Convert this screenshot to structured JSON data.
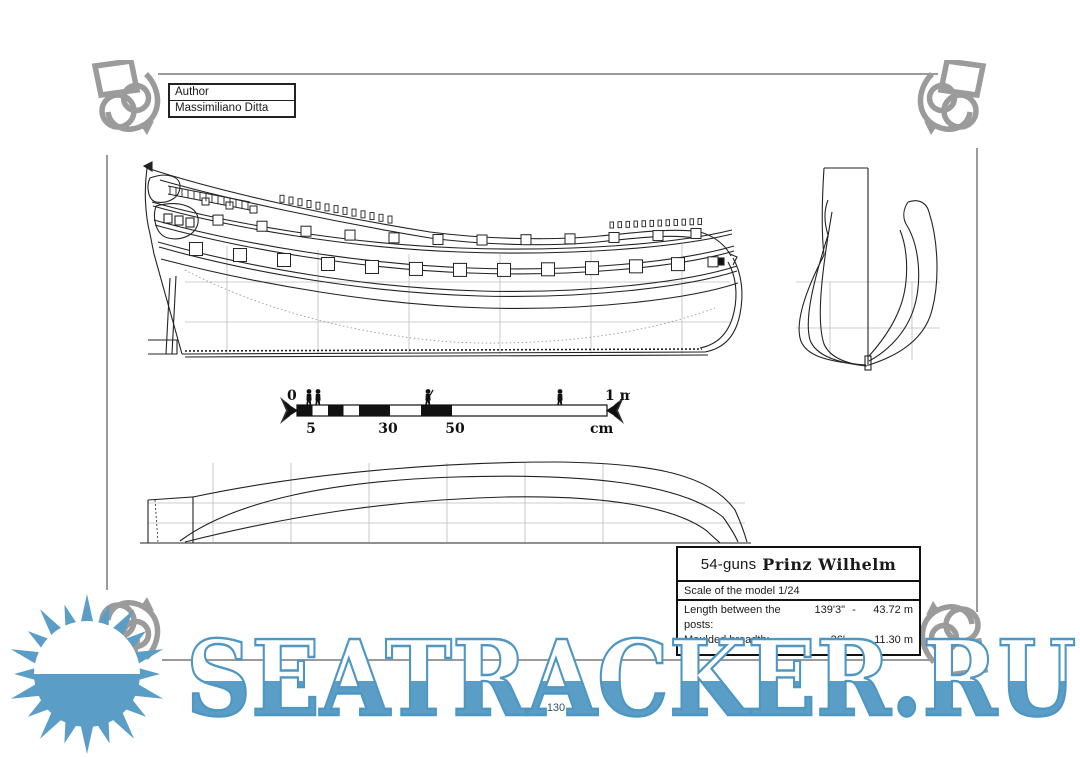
{
  "author_box": {
    "label": "Author",
    "value": "Massimiliano Ditta"
  },
  "title_box": {
    "gun_count": "54-guns",
    "ship_name": "Prinz Wilhelm",
    "scale_note": "Scale of the model 1/24",
    "dimensions": [
      {
        "label": "Length between the posts:",
        "imperial": "139'3\"",
        "sep": "-",
        "metric": "43.72 m"
      },
      {
        "label": "Moulded breadth:",
        "imperial": "36'",
        "sep": "-",
        "metric": "11.30 m"
      }
    ]
  },
  "scale_bar": {
    "start": "0",
    "end": "1 m",
    "unit": "cm",
    "ticks": [
      "5",
      "30",
      "50"
    ]
  },
  "watermark": {
    "text": "SEATRACKER.RU",
    "color": "#5A9EC8"
  },
  "page": {
    "number": "130"
  },
  "colors": {
    "watermark_blue": "#5A9EC8",
    "ornament_gray": "#9B9B9B",
    "ink_black": "#1A1A1A"
  },
  "icons": [
    "sun-logo",
    "corner-ornament",
    "scale-figure",
    "arrow-finial"
  ]
}
